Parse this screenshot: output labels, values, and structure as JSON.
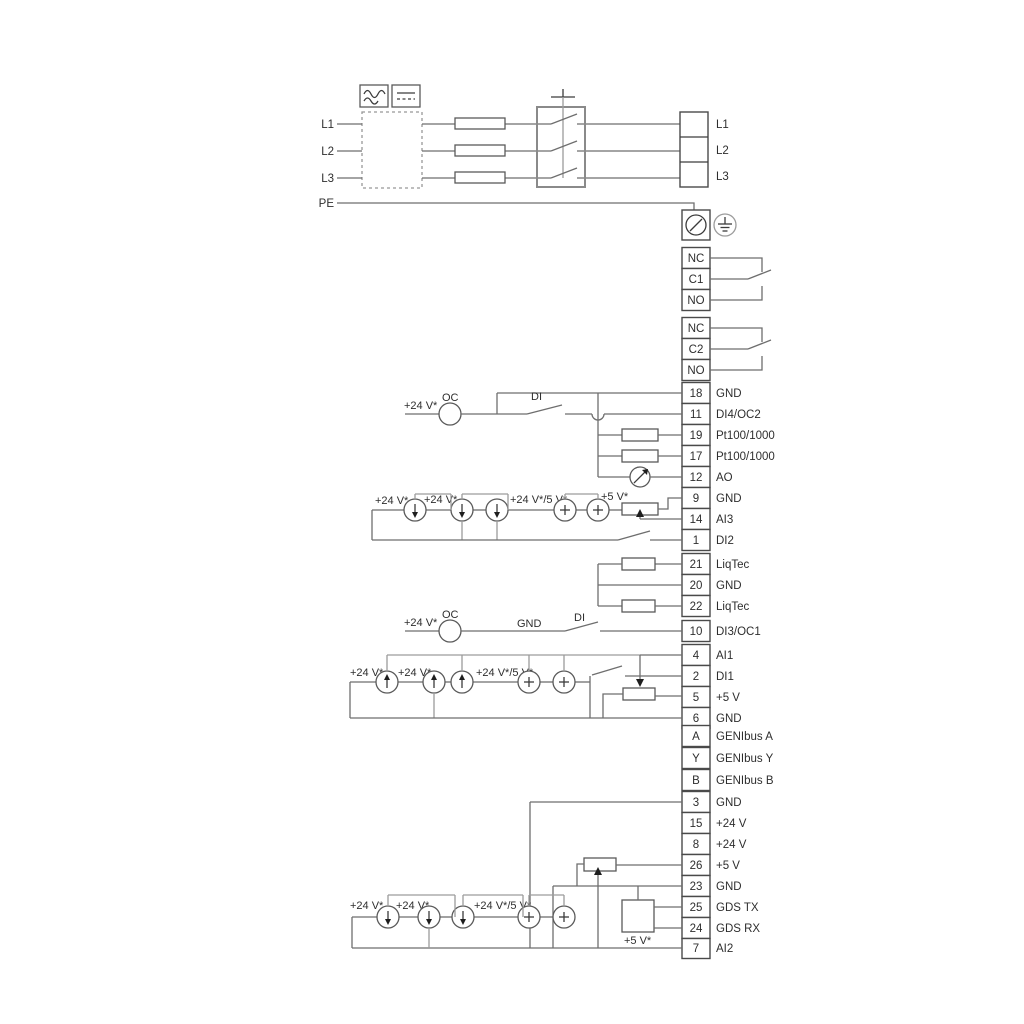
{
  "power": {
    "in": {
      "l1": "L1",
      "l2": "L2",
      "l3": "L3",
      "pe": "PE"
    },
    "out": {
      "l1": "L1",
      "l2": "L2",
      "l3": "L3"
    }
  },
  "relay1": {
    "nc": "NC",
    "c": "C1",
    "no": "NO"
  },
  "relay2": {
    "nc": "NC",
    "c": "C2",
    "no": "NO"
  },
  "stripA": {
    "rows": [
      {
        "n": "18",
        "label": "GND"
      },
      {
        "n": "11",
        "label": "DI4/OC2"
      },
      {
        "n": "19",
        "label": "Pt100/1000"
      },
      {
        "n": "17",
        "label": "Pt100/1000"
      },
      {
        "n": "12",
        "label": "AO"
      },
      {
        "n": "9",
        "label": "GND"
      },
      {
        "n": "14",
        "label": "AI3"
      },
      {
        "n": "1",
        "label": "DI2"
      }
    ]
  },
  "stripB": {
    "rows": [
      {
        "n": "21",
        "label": "LiqTec"
      },
      {
        "n": "20",
        "label": "GND"
      },
      {
        "n": "22",
        "label": "LiqTec"
      }
    ]
  },
  "stripC": {
    "rows": [
      {
        "n": "10",
        "label": "DI3/OC1"
      },
      {
        "n": "4",
        "label": "AI1"
      },
      {
        "n": "2",
        "label": "DI1"
      },
      {
        "n": "5",
        "label": "+5 V"
      },
      {
        "n": "6",
        "label": "GND"
      },
      {
        "n": "A",
        "label": "GENIbus A"
      },
      {
        "n": "Y",
        "label": "GENIbus Y"
      },
      {
        "n": "B",
        "label": "GENIbus B"
      }
    ]
  },
  "stripD": {
    "rows": [
      {
        "n": "3",
        "label": "GND"
      },
      {
        "n": "15",
        "label": "+24 V"
      },
      {
        "n": "8",
        "label": "+24 V"
      },
      {
        "n": "26",
        "label": "+5 V"
      },
      {
        "n": "23",
        "label": "GND"
      },
      {
        "n": "25",
        "label": "GDS TX"
      },
      {
        "n": "24",
        "label": "GDS RX"
      },
      {
        "n": "7",
        "label": "AI2"
      }
    ]
  },
  "ann": {
    "p24": "+24 V*",
    "p24_5": "+24 V*/5 V*",
    "p5": "+5 V*",
    "oc": "OC",
    "di": "DI",
    "gnd": "GND"
  }
}
